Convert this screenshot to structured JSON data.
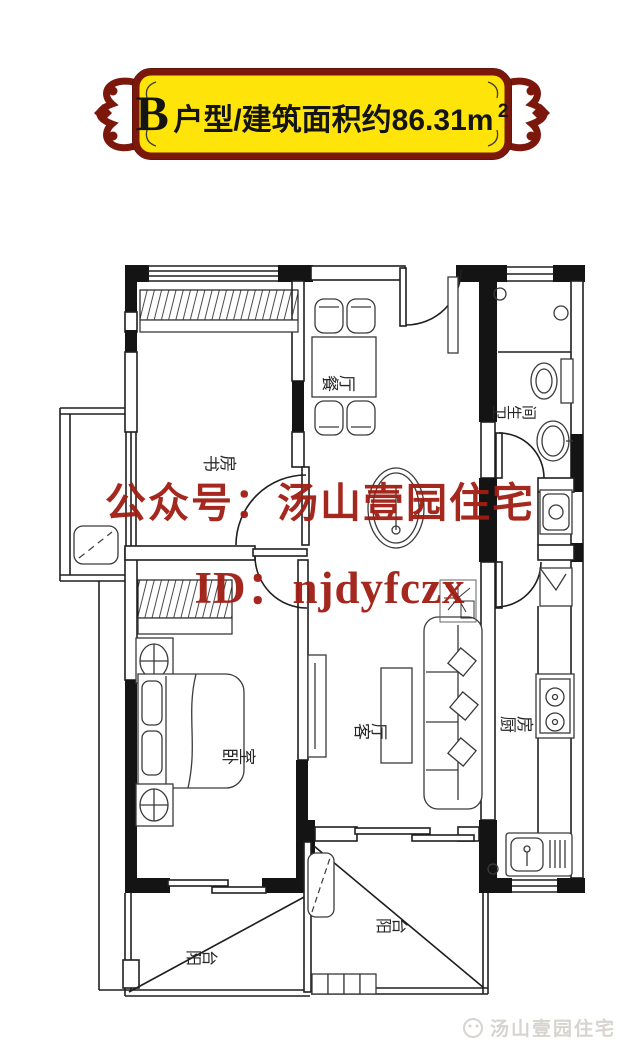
{
  "banner": {
    "unit_letter": "B",
    "title_text": "户型/建筑面积约86.31m",
    "area_superscript": "2",
    "panel_color": "#FFE409",
    "border_color": "#7C170C",
    "text_color": "#141414"
  },
  "watermarks": {
    "center_line1": "公众号：汤山壹园住宅",
    "center_line2": "ID：njdyfczx",
    "color": "#A01D12",
    "footer_text": "汤山壹园住宅",
    "footer_color": "#D7D4D0"
  },
  "rooms": {
    "study": "书房",
    "dining": "餐厅",
    "bathroom": "卫生间",
    "bedroom": "卧室",
    "living": "客厅",
    "kitchen": "厨房",
    "balcony_left": "阳台",
    "balcony_center": "阳台"
  }
}
